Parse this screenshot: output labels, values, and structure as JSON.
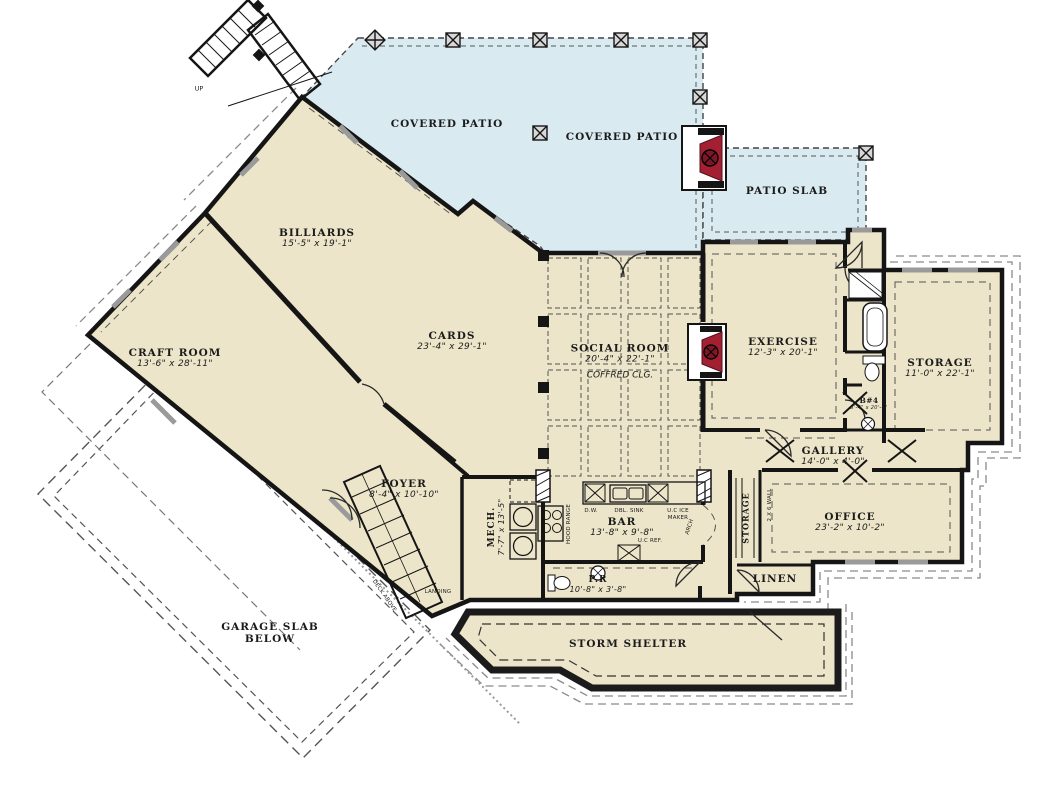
{
  "colors": {
    "room_fill": "#ece5c9",
    "patio_fill": "#d9eaf0",
    "wall": "#151515",
    "fireplace_red": "#a32033"
  },
  "rooms": [
    {
      "label": "COVERED PATIO",
      "dims": ""
    },
    {
      "label": "COVERED PATIO",
      "dims": ""
    },
    {
      "label": "PATIO SLAB",
      "dims": ""
    },
    {
      "label": "BILLIARDS",
      "dims": "15'-5\" x 19'-1\""
    },
    {
      "label": "CRAFT ROOM",
      "dims": "13'-6\" x 28'-11\""
    },
    {
      "label": "CARDS",
      "dims": "23'-4\" x 29'-1\""
    },
    {
      "label": "SOCIAL ROOM",
      "dims": "20'-4\" x 22'-1\"",
      "note": "COFFRED CLG."
    },
    {
      "label": "EXERCISE",
      "dims": "12'-3\" x 20'-1\""
    },
    {
      "label": "STORAGE",
      "dims": "11'-0\" x 22'-1\""
    },
    {
      "label": "B#4",
      "dims": "5'-4\" x 20'-6\""
    },
    {
      "label": "GALLERY",
      "dims": "14'-0\" x 4'-0\""
    },
    {
      "label": "OFFICE",
      "dims": "23'-2\" x 10'-2\""
    },
    {
      "label": "LINEN",
      "dims": ""
    },
    {
      "label": "BAR",
      "dims": "13'-8\" x 9'-8\""
    },
    {
      "label": "FOYER",
      "dims": "8'-4\" x 10'-10\""
    },
    {
      "label": "MECH.",
      "dims": "7'-7\" x 13'-5\""
    },
    {
      "label": "P.R",
      "dims": "10'-8\" x 3'-8\""
    },
    {
      "label": "STORM SHELTER",
      "dims": ""
    },
    {
      "label": "GARAGE SLAB",
      "line2": "BELOW"
    },
    {
      "label": "STORAGE",
      "dims": ""
    }
  ],
  "annotations": {
    "up": "UP",
    "landing": "LANDING",
    "deck": "DECK ABOVE",
    "wall_note": "2 X 6 WALL"
  },
  "fixtures": {
    "dw": "D.W.",
    "dbl_sink": "DBL. SINK",
    "ice1": "U.C ICE",
    "ice2": "MAKER",
    "arch": "ARCH",
    "range": "HOOD RANGE",
    "ref": "U.C REF."
  }
}
